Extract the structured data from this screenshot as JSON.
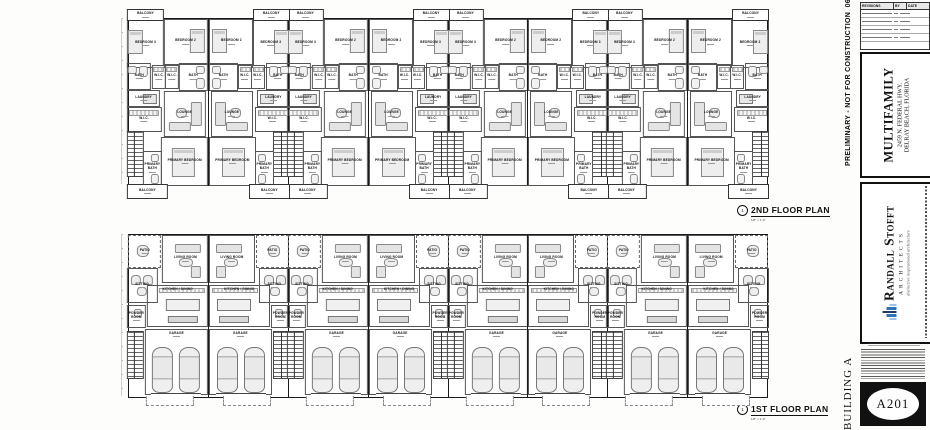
{
  "sheet": {
    "preliminary_note": "PRELIMINARY - NOT FOR CONSTRUCTION",
    "preliminary_date": "06-06-24"
  },
  "plan_labels": {
    "second": {
      "bubble": "1",
      "title": "2ND FLOOR PLAN",
      "scale": "1/8\" = 1'-0\""
    },
    "first": {
      "bubble": "1",
      "title": "1ST FLOOR PLAN",
      "scale": "1/8\" = 1'-0\""
    }
  },
  "plans": {
    "second_floor": {
      "unit_count": 8,
      "room_labels": {
        "balcony": "BALCONY",
        "bedroom2": "BEDROOM 2",
        "bedroom3": "BEDROOM 3",
        "wic": "W.I.C.",
        "bath": "BATH",
        "laundry": "LAUNDRY",
        "lounge": "LOUNGE",
        "primary_bedroom": "PRIMARY BEDROOM",
        "primary_bath": "PRIMARY BATH"
      }
    },
    "first_floor": {
      "unit_count": 8,
      "room_labels": {
        "patio": "PATIO",
        "living": "LIVING ROOM",
        "sitting": "SITTING",
        "kitchen": "KITCHEN / DINING",
        "powder": "POWDER ROOM",
        "garage": "GARAGE"
      }
    }
  },
  "titleblock": {
    "revision_table": {
      "headers": [
        "REVISIONS",
        "BY",
        "DATE"
      ],
      "row_count": 4
    },
    "project": {
      "line1": "MULTIFAMILY",
      "line2": "2459 N. FEDERAL HWY.",
      "line3": "DELRAY BEACH, FLORIDA"
    },
    "firm": {
      "name": "Randall Stofft",
      "subtitle": "ARCHITECTS",
      "tagline": "distinctive  inspirational  architecture"
    },
    "building_label": "BUILDING A",
    "sheet_number": "A201",
    "colors": {
      "logo_dark": "#1f3864",
      "logo_mid": "#2e75b6",
      "logo_light": "#9dc3e6"
    }
  }
}
